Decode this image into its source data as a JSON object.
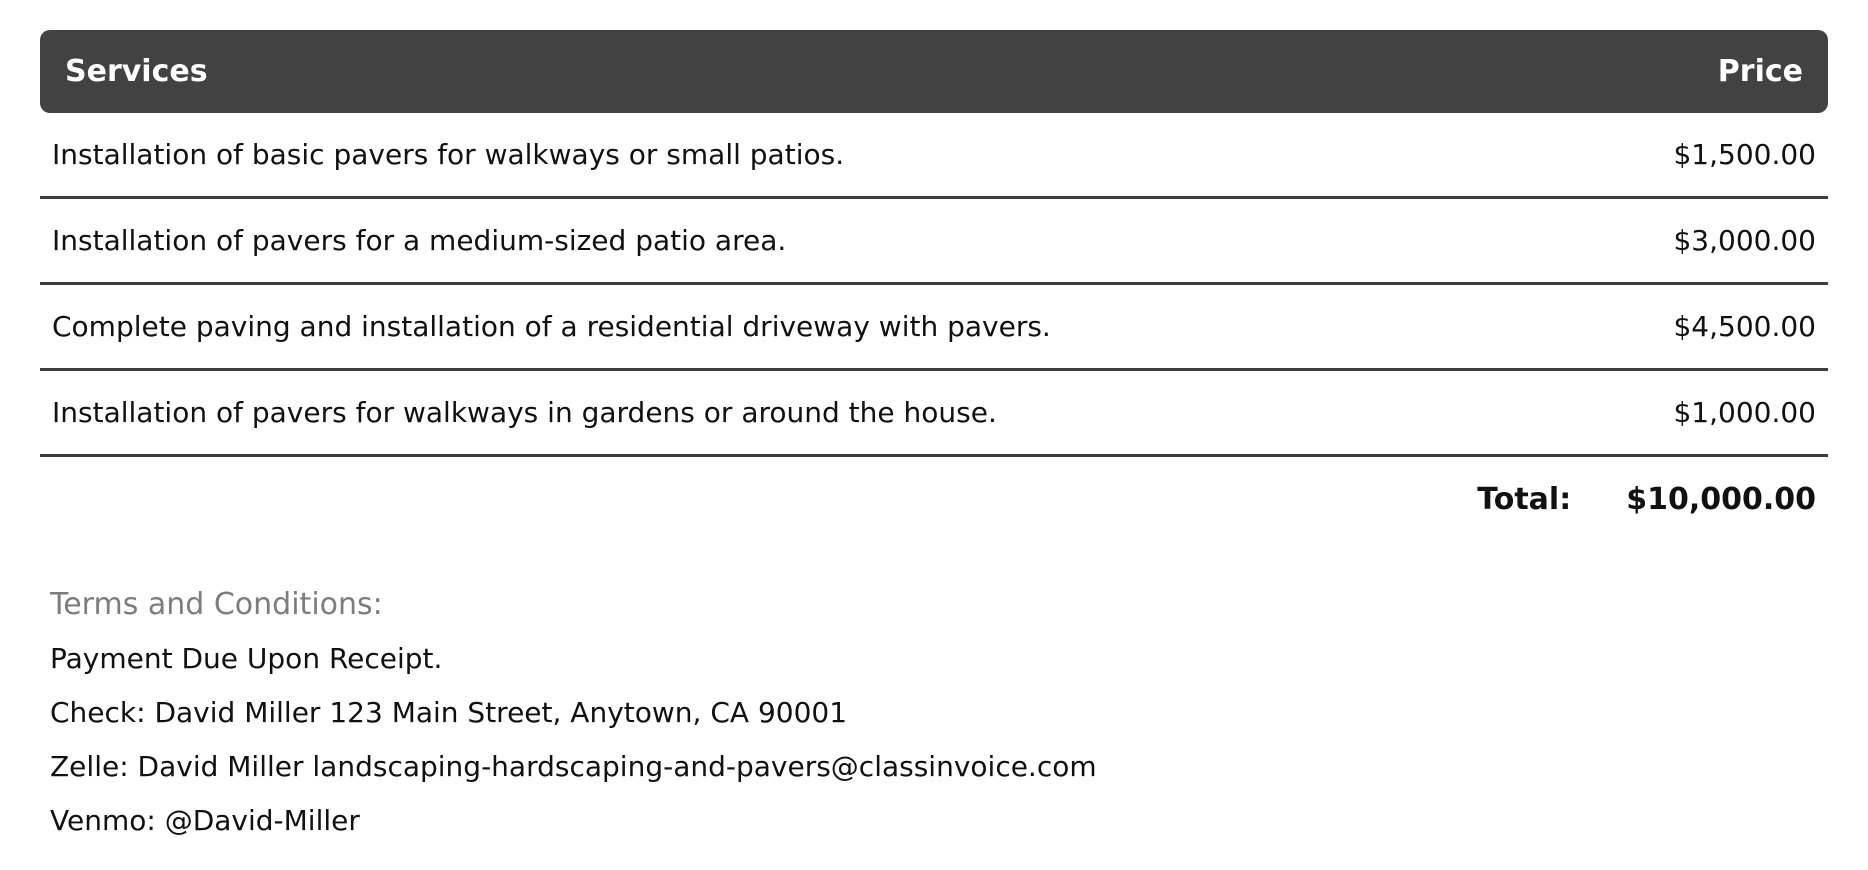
{
  "table": {
    "columns": {
      "services": "Services",
      "price": "Price"
    },
    "rows": [
      {
        "service": "Installation of basic pavers for walkways or small patios.",
        "price": "$1,500.00"
      },
      {
        "service": "Installation of pavers for a medium-sized patio area.",
        "price": "$3,000.00"
      },
      {
        "service": "Complete paving and installation of a residential driveway with pavers.",
        "price": "$4,500.00"
      },
      {
        "service": "Installation of pavers for walkways in gardens or around the house.",
        "price": "$1,000.00"
      }
    ],
    "total": {
      "label": "Total:",
      "value": "$10,000.00"
    }
  },
  "terms": {
    "heading": "Terms and Conditions:",
    "lines": [
      "Payment Due Upon Receipt.",
      "Check: David Miller 123 Main Street, Anytown, CA 90001",
      "Zelle: David Miller landscaping-hardscaping-and-pavers@classinvoice.com",
      "Venmo: @David-Miller"
    ]
  },
  "colors": {
    "header_bg": "#424242",
    "header_text": "#ffffff",
    "body_text": "#111111",
    "separator": "#3d3d3d",
    "terms_heading": "#7d7d7d"
  }
}
